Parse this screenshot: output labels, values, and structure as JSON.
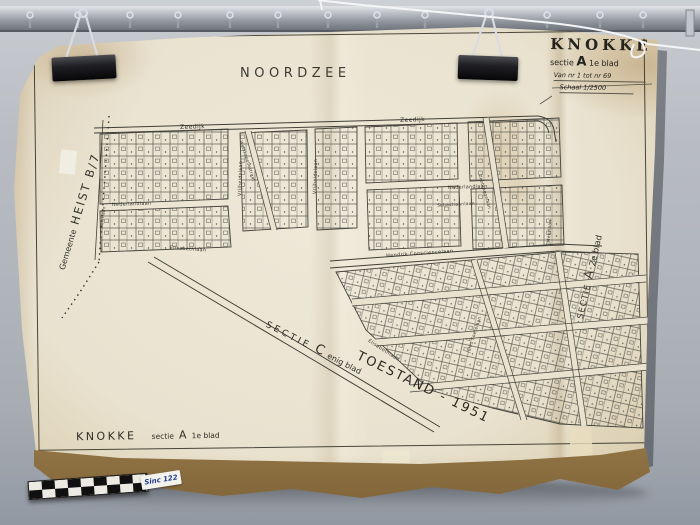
{
  "photo": {
    "tag_label": "Sinc 122"
  },
  "colors": {
    "paper": "#e9e2d0",
    "paper_edge": "#c9ad7c",
    "ink": "#3a392f",
    "wall": "#b4b8bf",
    "tag_text": "#27408f"
  },
  "title_block": {
    "title": "KNOKKE",
    "subtitle_pre": "sectie",
    "subtitle_section": "A",
    "subtitle_post": "1e blad",
    "range_line": "Van nr 1 tot nr 69",
    "scale_line": "Schaal 1/2500"
  },
  "labels": {
    "sea": "NOORDZEE",
    "municipality_pre": "Gemeente",
    "municipality_name": "HEIST B/7",
    "section_c_pre": "SECTIE",
    "section_c_letter": "C",
    "section_c_post": "enig blad",
    "state": "TOESTAND - 1951",
    "a2_pre": "SECTIE",
    "a2_letter": "A",
    "a2_post": "2e blad",
    "corner_name": "KNOKKE",
    "corner_pre": "sectie",
    "corner_letter": "A",
    "corner_post": "1e blad"
  },
  "streets": [
    {
      "label": "Zeedijk",
      "x": 180,
      "y": 124,
      "rot": -2,
      "size": 6
    },
    {
      "label": "Zeedijk",
      "x": 400,
      "y": 117,
      "rot": -2,
      "size": 6
    },
    {
      "label": "Nederlandlaan",
      "x": 112,
      "y": 202,
      "rot": -2,
      "size": 4.8
    },
    {
      "label": "Nederlandlaan",
      "x": 448,
      "y": 185,
      "rot": -2,
      "size": 4.8
    },
    {
      "label": "Vrijheidslaan",
      "x": 237,
      "y": 196,
      "rot": -88,
      "size": 4.8
    },
    {
      "label": "Vrijheidslaan",
      "x": 312,
      "y": 194,
      "rot": -88,
      "size": 4.8
    },
    {
      "label": "Westkapellestraat",
      "x": 243,
      "y": 140,
      "rot": 72,
      "size": 4.2
    },
    {
      "label": "Sebastiaanlaan",
      "x": 437,
      "y": 203,
      "rot": -3,
      "size": 4.4
    },
    {
      "label": "Zeebruggelaan",
      "x": 482,
      "y": 174,
      "rot": 74,
      "size": 4.2
    },
    {
      "label": "Meerlaan",
      "x": 546,
      "y": 242,
      "rot": -85,
      "size": 4.4
    },
    {
      "label": "Hendrik Consciencelaan",
      "x": 386,
      "y": 253,
      "rot": -4,
      "size": 5
    },
    {
      "label": "Elisabethlaan",
      "x": 170,
      "y": 245,
      "rot": 4,
      "size": 4.8
    },
    {
      "label": "Elisabethlaan",
      "x": 370,
      "y": 338,
      "rot": 33,
      "size": 4.8
    },
    {
      "label": "Jules Soetelaan",
      "x": 466,
      "y": 352,
      "rot": -72,
      "size": 4.4
    },
    {
      "label": "Heistlaan",
      "x": 99,
      "y": 228,
      "rot": -82,
      "size": 4.2
    }
  ]
}
